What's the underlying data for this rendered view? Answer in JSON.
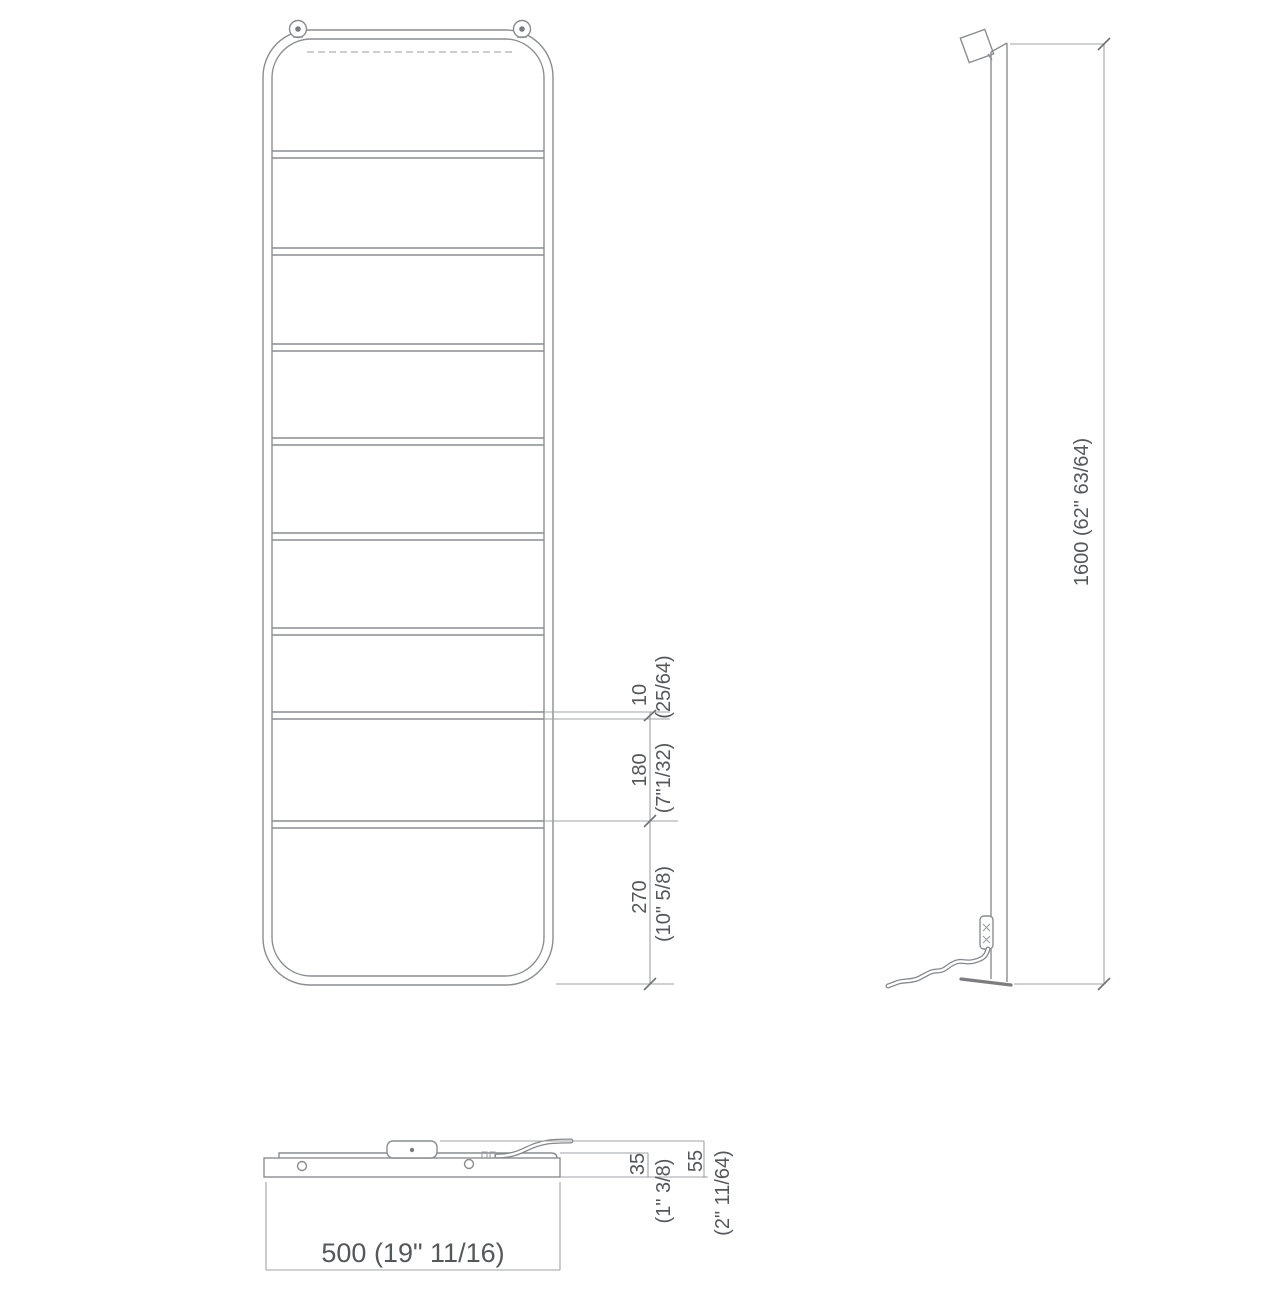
{
  "drawing_title": "heated towel ladder rail - dimensional drawing",
  "front_view": {
    "rung_diameter": {
      "mm": "10",
      "inch": "(25/64)"
    },
    "rung_spacing": {
      "mm": "180",
      "inch": "(7\"1/32)"
    },
    "bottom_section": {
      "mm": "270",
      "inch": "(10\" 5/8)"
    }
  },
  "side_view": {
    "height": "1600 (62\" 63/64)"
  },
  "bottom_view": {
    "width": "500 (19\" 11/16)",
    "panel_depth": {
      "mm": "35",
      "inch": "(1\" 3/8)"
    },
    "total_depth": {
      "mm": "55",
      "inch": "(2\" 11/64)"
    }
  },
  "colors": {
    "line": "#8a8d90",
    "dimension_line": "#a0a3a6",
    "text": "#55585b",
    "background": "#ffffff"
  }
}
